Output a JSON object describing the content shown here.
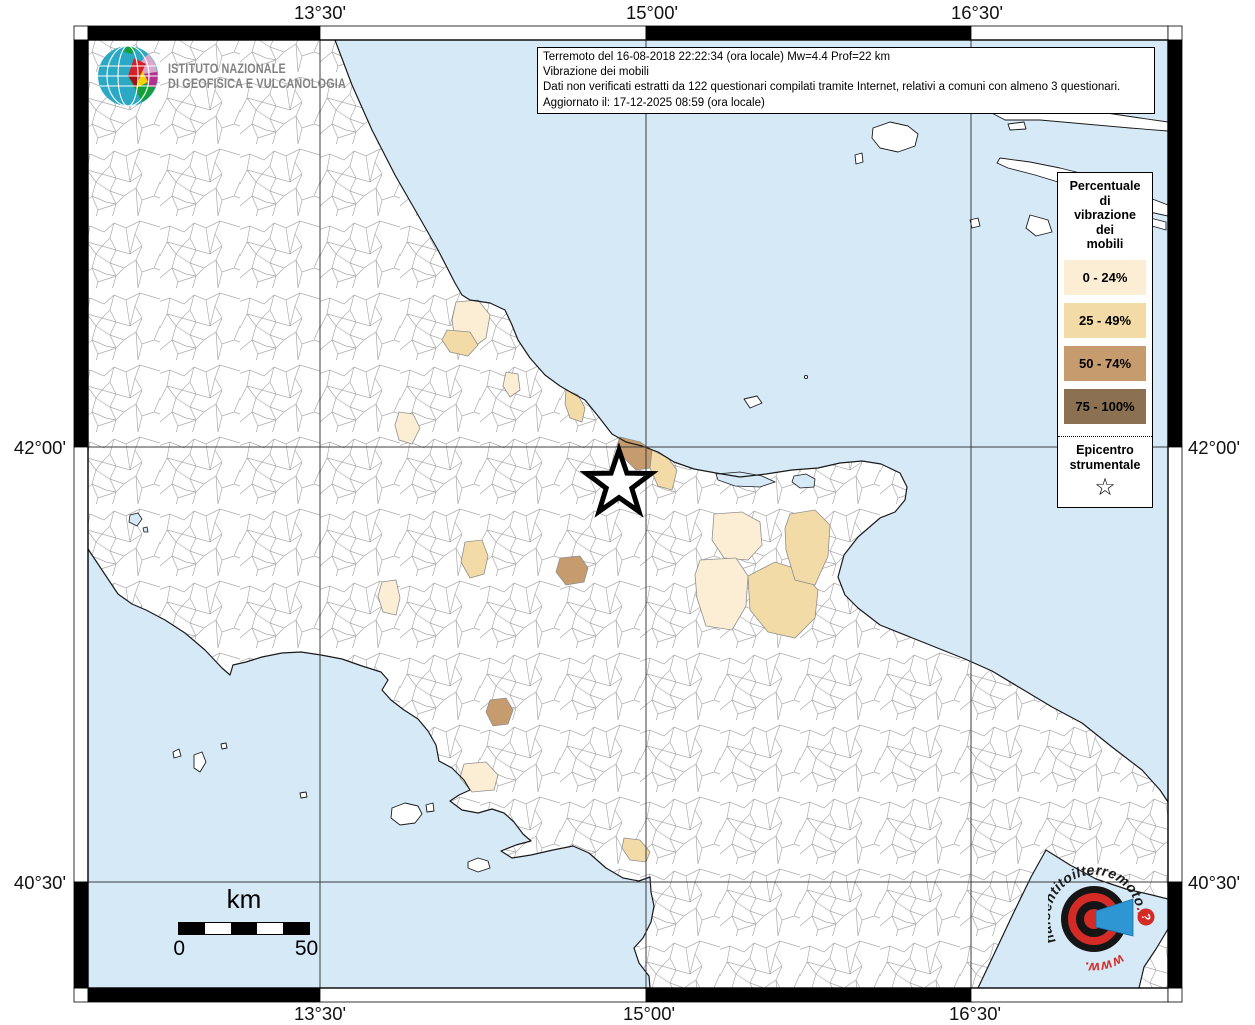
{
  "info_box": {
    "lines": [
      "Terremoto del 16-08-2018 22:22:34 (ora locale) Mw=4.4 Prof=22 km",
      "Vibrazione dei mobili",
      "Dati non verificati estratti da 122 questionari compilati tramite Internet, relativi a comuni con almeno 3 questionari.",
      "Aggiornato il: 17-12-2025 08:59 (ora locale)"
    ]
  },
  "ingv_logo": {
    "line1": "ISTITUTO NAZIONALE",
    "line2": "DI GEOFISICA E VULCANOLOGIA"
  },
  "legend": {
    "title_lines": [
      "Percentuale",
      "di",
      "vibrazione",
      "dei",
      "mobili"
    ],
    "items": [
      {
        "label": "0 - 24%",
        "color": "#FCEED5"
      },
      {
        "label": "25 - 49%",
        "color": "#F2DBA6"
      },
      {
        "label": "50 - 74%",
        "color": "#C69C6E"
      },
      {
        "label": "75 - 100%",
        "color": "#8B7052"
      }
    ],
    "epicenter_lines": [
      "Epicentro",
      "strumentale"
    ],
    "epicenter_symbol": "☆"
  },
  "axis_labels": {
    "top": [
      "13°30'",
      "15°00'",
      "16°30'"
    ],
    "bottom": [
      "13°30'",
      "15°00'",
      "16°30'"
    ],
    "left": [
      "42°00'",
      "40°30'"
    ],
    "right": [
      "42°00'",
      "40°30'"
    ]
  },
  "scale_bar": {
    "unit": "km",
    "min": "0",
    "max": "50"
  },
  "watermark": {
    "prefix": "www.",
    "main": "haisentitoilterremoto",
    "suffix": ".it",
    "question_mark": "?"
  },
  "epicenter_marker": {
    "x": 619,
    "y": 484
  },
  "colors": {
    "sea": "#D5E9F7",
    "land": "#FFFFFF",
    "grid": "#3C3C3C",
    "coast": "#1A1A1A",
    "boundary": "#ABABAB"
  }
}
